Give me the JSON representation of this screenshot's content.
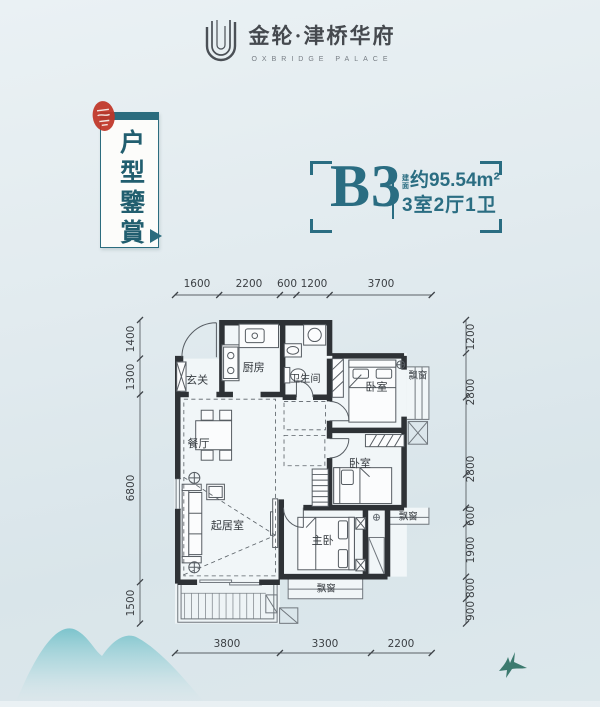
{
  "colors": {
    "teal": "#2a6d82",
    "teal_dark": "#215e6f",
    "seal_red": "#bf3527",
    "ink": "#45494e",
    "dim_text": "#3b3f43",
    "wall": "#2e3236",
    "mountain": "#72c0c9",
    "bird": "#3c7a6f"
  },
  "header": {
    "logo_icon": "double-u-monogram",
    "brand": "金轮·津桥华府",
    "brand_sub": "OXBRIDGE PALACE"
  },
  "banner": {
    "title": "户型鑒賞",
    "seal_icon": "red-seal-stamp"
  },
  "unit": {
    "code": "B3",
    "area_prefix": "建面",
    "area_value": "约95.54m²",
    "layout": "3室2厅1卫"
  },
  "floorplan": {
    "dims_top": [
      "1600",
      "2200",
      "600",
      "1200",
      "3700"
    ],
    "dims_bottom": [
      "3800",
      "3300",
      "2200"
    ],
    "dims_left": [
      "1400",
      "1300",
      "6800",
      "1500"
    ],
    "dims_right": [
      "1200",
      "2800",
      "2800",
      "600",
      "1900",
      "800",
      "900"
    ],
    "rooms": [
      {
        "label": "玄关"
      },
      {
        "label": "厨房"
      },
      {
        "label": "卫生间"
      },
      {
        "label": "卧室"
      },
      {
        "label": "餐厅"
      },
      {
        "label": "卧室"
      },
      {
        "label": "起居室"
      },
      {
        "label": "主卧"
      }
    ],
    "bay_windows": [
      {
        "label": "飘窗"
      },
      {
        "label": "飘窗"
      },
      {
        "label": "飘窗"
      }
    ]
  }
}
